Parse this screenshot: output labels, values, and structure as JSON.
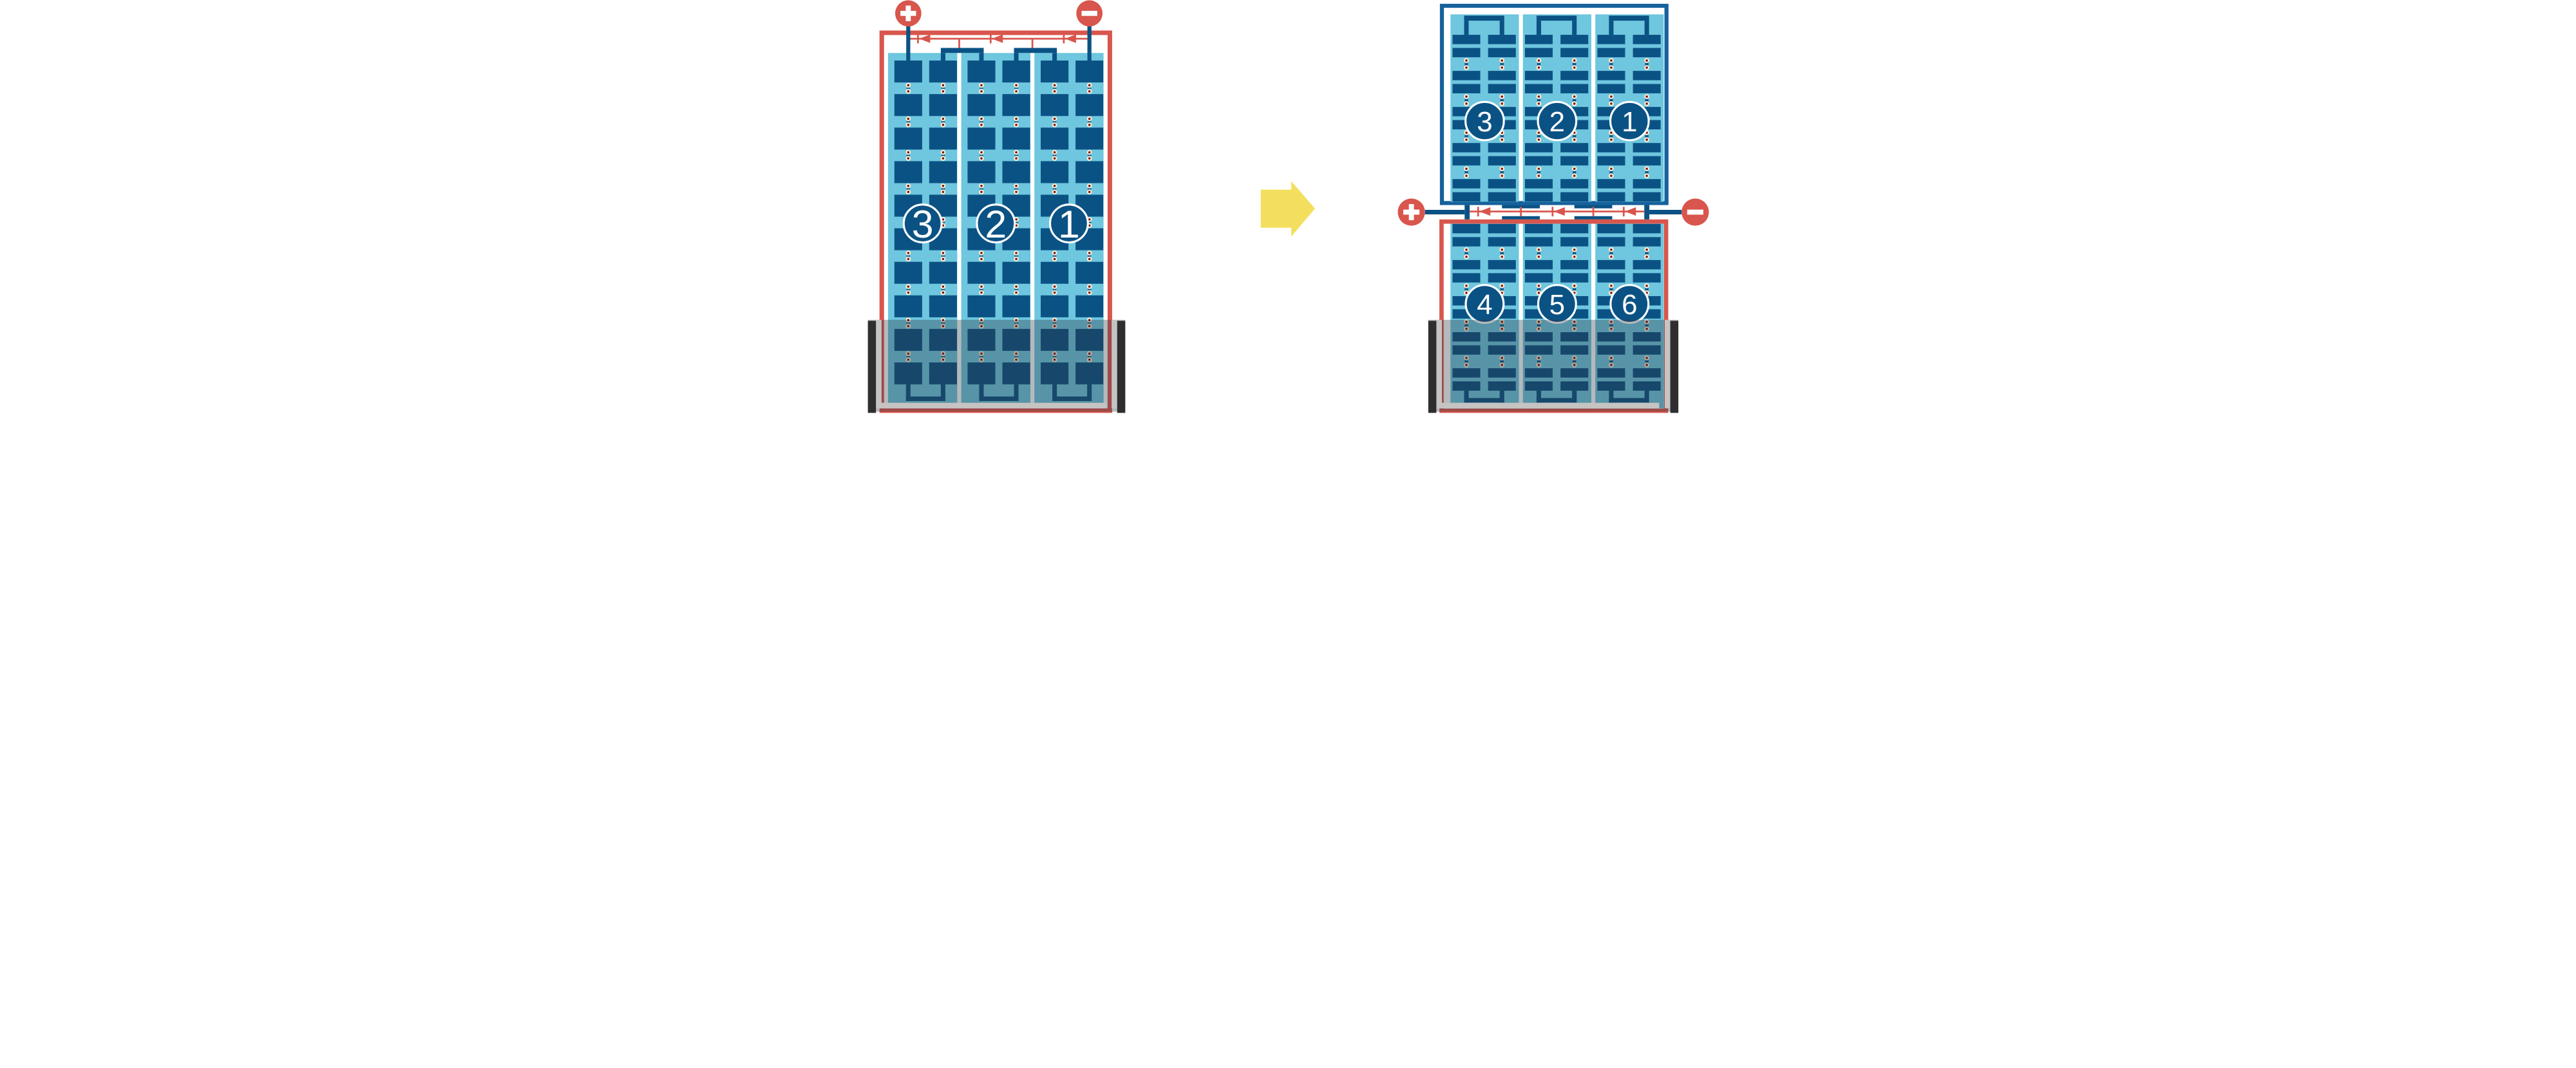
{
  "diagram": {
    "colors": {
      "red": "#D8564D",
      "navy": "#0B5284",
      "frame_blue": "#15619C",
      "light_blue": "#6EC6DF",
      "cream": "#F7EDD3",
      "dot_red": "#7B1215",
      "yellow": "#F3DF5D",
      "white": "#FFFFFF",
      "overlay": "rgba(45,55,62,0.35)",
      "pane_gray": "#C6C4C3",
      "pane_black": "#2E2E2E"
    },
    "left_panel": {
      "module_labels": [
        "3",
        "2",
        "1"
      ],
      "plus_label": "+",
      "minus_label": "−",
      "columns": 3,
      "cell_rows": 10,
      "bypass_diodes": 3,
      "shaded_bottom": true
    },
    "arrow_icon": "arrow-right-icon",
    "right_panel": {
      "top_module_labels": [
        "3",
        "2",
        "1"
      ],
      "bottom_module_labels": [
        "4",
        "5",
        "6"
      ],
      "plus_label": "+",
      "minus_label": "−",
      "bypass_diodes": 3,
      "shaded_bottom": true
    }
  }
}
